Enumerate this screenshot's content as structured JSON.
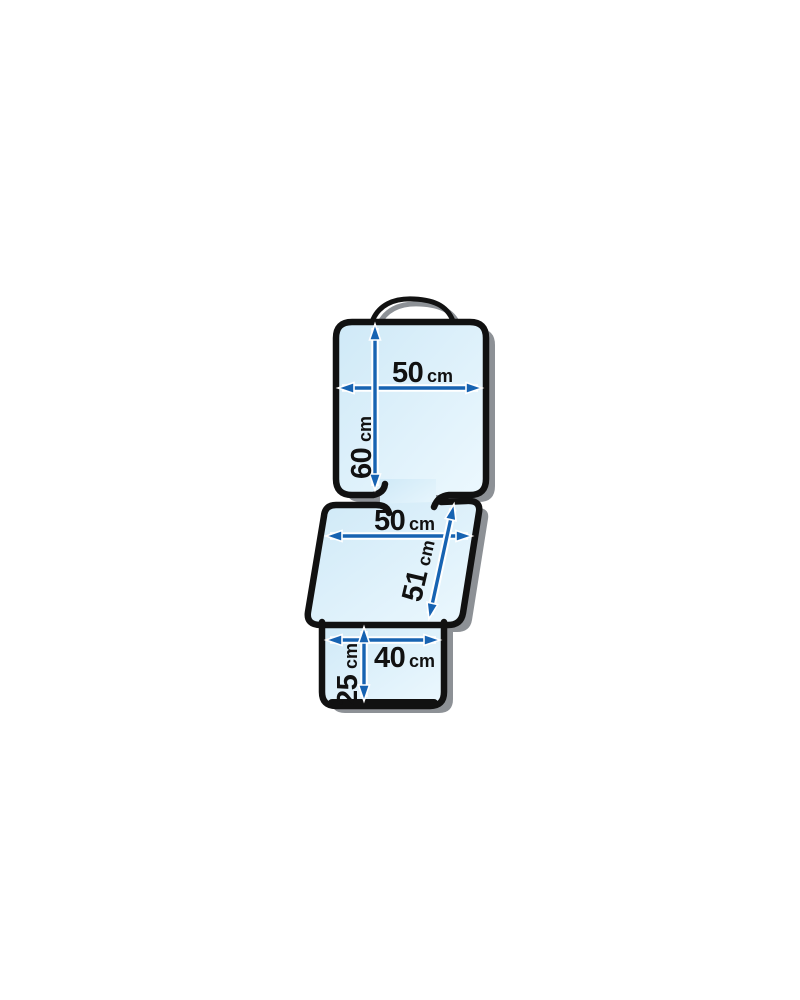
{
  "figure": {
    "colors": {
      "background": "#ffffff",
      "outline": "#111111",
      "shadow": "#8d9196",
      "fill_light": "#cfe9f7",
      "fill_lighter": "#ecf8fe",
      "arrow": "#1763b2",
      "label": "#111111"
    },
    "sections": {
      "backrest": {
        "width": {
          "value": "50",
          "unit": "cm"
        },
        "height": {
          "value": "60",
          "unit": "cm"
        }
      },
      "seat": {
        "width": {
          "value": "50",
          "unit": "cm"
        },
        "depth": {
          "value": "51",
          "unit": "cm"
        }
      },
      "front_flap": {
        "width": {
          "value": "40",
          "unit": "cm"
        },
        "height": {
          "value": "25",
          "unit": "cm"
        }
      }
    }
  }
}
